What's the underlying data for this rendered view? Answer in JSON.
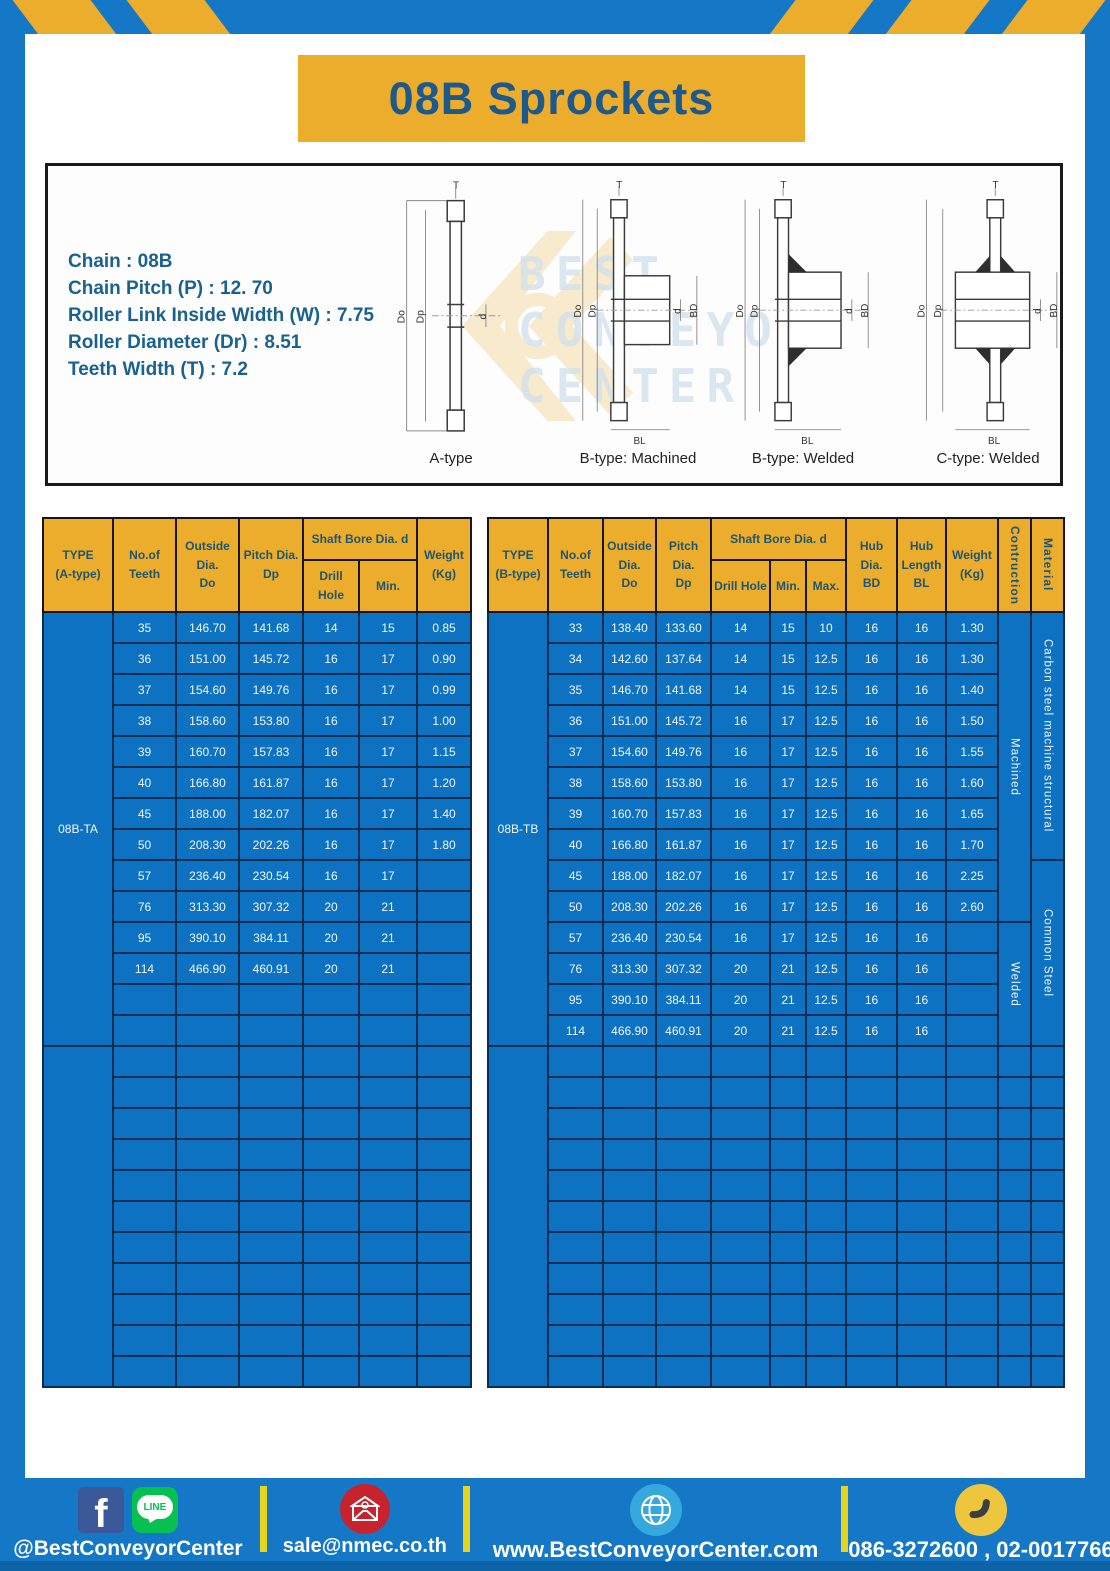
{
  "banner": {
    "title": "08B Sprockets"
  },
  "specs": {
    "lines": [
      "Chain : 08B",
      "Chain Pitch (P) : 12. 70",
      "Roller Link Inside Width (W) : 7.75",
      "Roller Diameter (Dr) : 8.51",
      "Teeth Width (T) : 7.2"
    ]
  },
  "diagrams": {
    "captions": [
      "A-type",
      "B-type: Machined",
      "B-type: Welded",
      "C-type: Welded"
    ],
    "dims": {
      "t": "T",
      "do": "Do",
      "dp": "Dp",
      "d": "d",
      "bd": "BD",
      "bl": "BL"
    }
  },
  "watermark": {
    "lines": [
      "BEST",
      "CONVEYOR",
      "CENTER"
    ]
  },
  "table_a": {
    "title_cell": {
      "line1": "TYPE",
      "line2": "(A-type)"
    },
    "headers": {
      "teeth": [
        "No.of",
        "Teeth"
      ],
      "outside": [
        "Outside",
        "Dia.",
        "Do"
      ],
      "pitch": [
        "Pitch Dia.",
        "Dp"
      ],
      "shaft_bore": "Shaft Bore Dia. d",
      "drill": "Drill Hole",
      "min": "Min.",
      "weight": [
        "Weight",
        "(Kg)"
      ]
    },
    "type_label": "08B-TA",
    "rows": [
      [
        "35",
        "146.70",
        "141.68",
        "14",
        "15",
        "0.85"
      ],
      [
        "36",
        "151.00",
        "145.72",
        "16",
        "17",
        "0.90"
      ],
      [
        "37",
        "154.60",
        "149.76",
        "16",
        "17",
        "0.99"
      ],
      [
        "38",
        "158.60",
        "153.80",
        "16",
        "17",
        "1.00"
      ],
      [
        "39",
        "160.70",
        "157.83",
        "16",
        "17",
        "1.15"
      ],
      [
        "40",
        "166.80",
        "161.87",
        "16",
        "17",
        "1.20"
      ],
      [
        "45",
        "188.00",
        "182.07",
        "16",
        "17",
        "1.40"
      ],
      [
        "50",
        "208.30",
        "202.26",
        "16",
        "17",
        "1.80"
      ],
      [
        "57",
        "236.40",
        "230.54",
        "16",
        "17",
        ""
      ],
      [
        "76",
        "313.30",
        "307.32",
        "20",
        "21",
        ""
      ],
      [
        "95",
        "390.10",
        "384.11",
        "20",
        "21",
        ""
      ],
      [
        "114",
        "466.90",
        "460.91",
        "20",
        "21",
        ""
      ]
    ],
    "trailing_empty_rows": 2,
    "second_block_rows": 11
  },
  "table_b": {
    "title_cell": {
      "line1": "TYPE",
      "line2": "(B-type)"
    },
    "headers": {
      "teeth": [
        "No.of",
        "Teeth"
      ],
      "outside": [
        "Outside",
        "Dia.",
        "Do"
      ],
      "pitch": [
        "Pitch Dia.",
        "Dp"
      ],
      "shaft_bore": "Shaft Bore Dia. d",
      "drill": "Drill Hole",
      "min": "Min.",
      "max": "Max.",
      "hub_dia": [
        "Hub Dia.",
        "BD"
      ],
      "hub_len": [
        "Hub",
        "Length",
        "BL"
      ],
      "weight": [
        "Weight",
        "(Kg)"
      ],
      "construction": "Contruction",
      "material": "Material"
    },
    "type_label": "08B-TB",
    "rows": [
      [
        "33",
        "138.40",
        "133.60",
        "14",
        "15",
        "10",
        "16",
        "16",
        "1.30"
      ],
      [
        "34",
        "142.60",
        "137.64",
        "14",
        "15",
        "12.5",
        "16",
        "16",
        "1.30"
      ],
      [
        "35",
        "146.70",
        "141.68",
        "14",
        "15",
        "12.5",
        "16",
        "16",
        "1.40"
      ],
      [
        "36",
        "151.00",
        "145.72",
        "16",
        "17",
        "12.5",
        "16",
        "16",
        "1.50"
      ],
      [
        "37",
        "154.60",
        "149.76",
        "16",
        "17",
        "12.5",
        "16",
        "16",
        "1.55"
      ],
      [
        "38",
        "158.60",
        "153.80",
        "16",
        "17",
        "12.5",
        "16",
        "16",
        "1.60"
      ],
      [
        "39",
        "160.70",
        "157.83",
        "16",
        "17",
        "12.5",
        "16",
        "16",
        "1.65"
      ],
      [
        "40",
        "166.80",
        "161.87",
        "16",
        "17",
        "12.5",
        "16",
        "16",
        "1.70"
      ],
      [
        "45",
        "188.00",
        "182.07",
        "16",
        "17",
        "12.5",
        "16",
        "16",
        "2.25"
      ],
      [
        "50",
        "208.30",
        "202.26",
        "16",
        "17",
        "12.5",
        "16",
        "16",
        "2.60"
      ],
      [
        "57",
        "236.40",
        "230.54",
        "16",
        "17",
        "12.5",
        "16",
        "16",
        ""
      ],
      [
        "76",
        "313.30",
        "307.32",
        "20",
        "21",
        "12.5",
        "16",
        "16",
        ""
      ],
      [
        "95",
        "390.10",
        "384.11",
        "20",
        "21",
        "12.5",
        "16",
        "16",
        ""
      ],
      [
        "114",
        "466.90",
        "460.91",
        "20",
        "21",
        "12.5",
        "16",
        "16",
        ""
      ]
    ],
    "construction_spans": [
      {
        "label": "Machined",
        "rows": 10
      },
      {
        "label": "Welded",
        "rows": 4
      }
    ],
    "material_spans": [
      {
        "label": "Carbon steel machine structural",
        "rows": 8
      },
      {
        "label": "Common Steel",
        "rows": 6
      }
    ],
    "second_block_rows": 11
  },
  "footer": {
    "facebook": "@BestConveyorCenter",
    "line_badge": "LINE",
    "email": "sale@nmec.co.th",
    "website": "www.BestConveyorCenter.com",
    "phone": "086-3272600 , 02-0017766"
  },
  "colors": {
    "frame_blue": "#1478c6",
    "gold": "#ecac2c",
    "table_blue": "#0e72c2",
    "border_navy": "#0a2d52",
    "header_text": "#1f566f",
    "title_text": "#1e598c",
    "facebook_blue": "#3b5998",
    "line_green": "#06c152",
    "mail_red": "#c8232c",
    "globe_blue": "#35a8dc",
    "phone_yellow": "#edc63d",
    "divider_yellow": "#e7d41f",
    "bottom_strip": "#0d63a5"
  }
}
